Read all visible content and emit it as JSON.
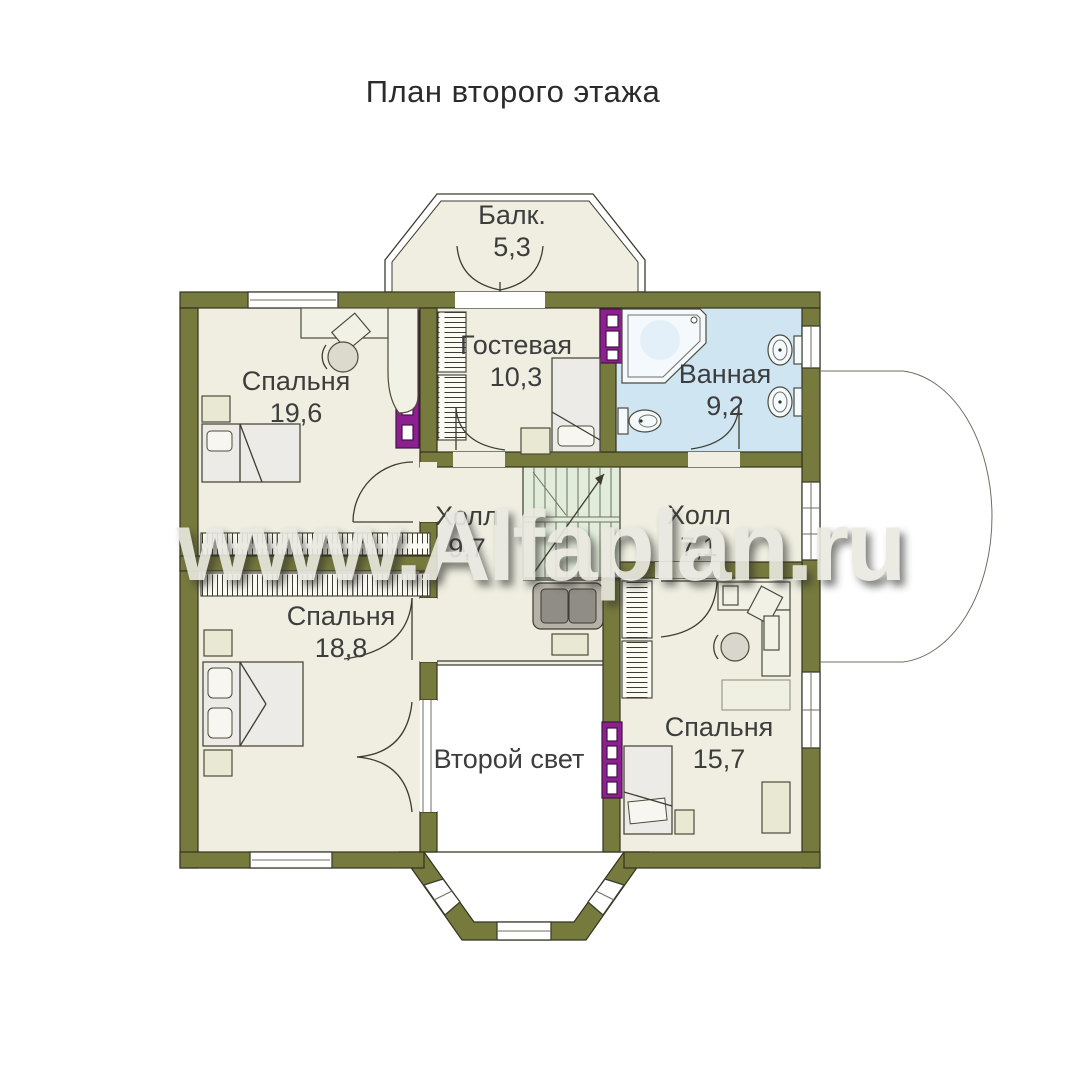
{
  "title": "План второго этажа",
  "watermark": "www.Alfaplan.ru",
  "rooms": [
    {
      "id": "balcony",
      "name": "Балк.",
      "area": "5,3"
    },
    {
      "id": "bedroom-1",
      "name": "Спальня",
      "area": "19,6"
    },
    {
      "id": "guest-room",
      "name": "Гостевая",
      "area": "10,3"
    },
    {
      "id": "bathroom",
      "name": "Ванная",
      "area": "9,2"
    },
    {
      "id": "hall-left",
      "name": "Холл",
      "area": "9,7"
    },
    {
      "id": "hall-right",
      "name": "Холл",
      "area": "7,1"
    },
    {
      "id": "bedroom-2",
      "name": "Спальня",
      "area": "18,8"
    },
    {
      "id": "second-light",
      "name": "Второй свет",
      "area": ""
    },
    {
      "id": "bedroom-3",
      "name": "Спальня",
      "area": "15,7"
    }
  ],
  "colors": {
    "wall": "#777a3d",
    "floor": "#efeee1",
    "bath": "#cfe5f1",
    "stairs": "#e2ecdb",
    "purple": "#8c2090",
    "watermark": "#eae9e1",
    "ink": "#3d3d3d"
  }
}
